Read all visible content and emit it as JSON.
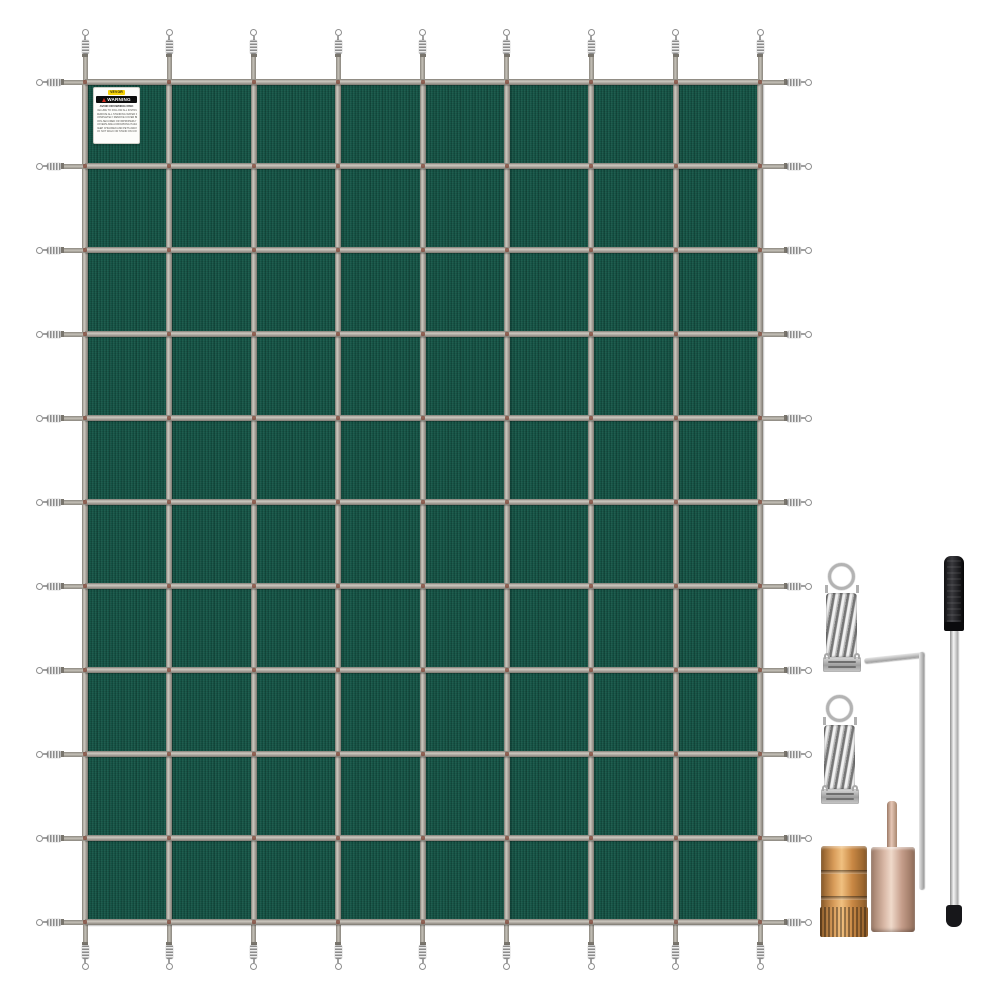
{
  "label": {
    "brand": "VEVOR",
    "warning": "WARNING",
    "title": "AVOID  DROWNING  RISK",
    "lines": [
      "FAILURE TO FOLLOW ALL INSTRUCTIONS MAY RESULT IN INJURY",
      "REMOVE ALL STANDING WATER FROM COVER",
      "COMPLETELY REMOVE COVER BEFORE USE OF POOL",
      "NON-SECURED OR IMPROPERLY SECURED",
      "COVERS ARE A DROWNING HAZARD",
      "KEEP CHILDREN AND PETS AWAY FROM COVER",
      "DO NOT WALK OR STAND ON COVER"
    ]
  },
  "cover": {
    "x": 85,
    "y": 82,
    "width": 675,
    "height": 840,
    "columns": 9,
    "rows": 11,
    "strap_width": 6,
    "tail_top": 53,
    "tail_bottom": 48,
    "tail_left": 49,
    "tail_right": 52
  },
  "colors": {
    "fabric": "#175849",
    "strap": "#b2ada5",
    "strap_edge": "#86827b",
    "stitch": "#7e4435",
    "hardware_silver": "#c7c7c7",
    "brass": "#c98a4a",
    "copper": "#d4b3a0",
    "rod_handle": "#1b1b1e",
    "label_yellow": "#f7d308",
    "warning_red": "#d42b1e",
    "background": "#ffffff"
  },
  "accessories": {
    "spring_count": 2,
    "items": [
      "stainless-anchor-spring",
      "stainless-anchor-spring",
      "hex-key",
      "installation-rod",
      "brass-anchor",
      "copper-tamping-tool"
    ]
  }
}
